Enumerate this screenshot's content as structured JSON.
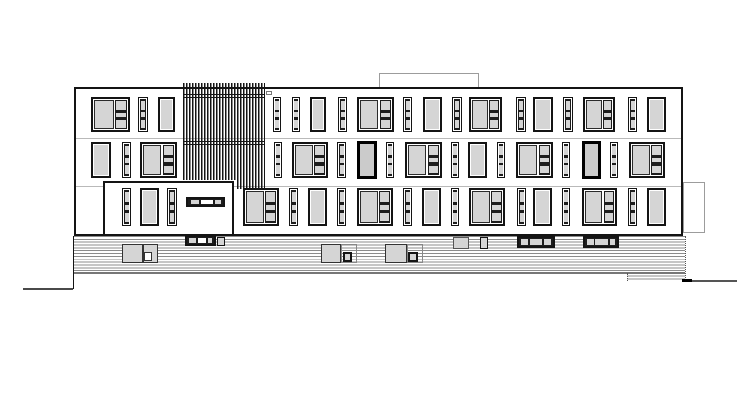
{
  "drawing": {
    "kind": "architectural-elevation",
    "canvas": {
      "width": 755,
      "height": 412,
      "background": "#ffffff"
    }
  },
  "colors": {
    "ink": "#141414",
    "pane": "#d5d5d5",
    "paneDark": "#cbcbcb",
    "innerDark": "#1d1d1d",
    "floorLine": "#b9b9b9",
    "stripe": "#8c8c8c",
    "lightLine": "#9c9c9c",
    "ground": "#4a4a4a",
    "white": "#ffffff"
  },
  "window_styles": {
    "plain": {
      "border": 2,
      "bg": "pane",
      "rim": 1
    },
    "thick": {
      "border": 3,
      "bg": "paneDark"
    },
    "narrow": {
      "border": 1.2,
      "inner_inset": 1,
      "inner": "innerDark",
      "panes": [
        [
          6,
          28
        ],
        [
          43,
          15
        ],
        [
          67,
          27
        ]
      ],
      "pane_l": 10,
      "pane_w": 80
    },
    "composite": {
      "border": 2,
      "left": [
        3,
        4,
        56,
        92
      ],
      "col": [
        63,
        2,
        34,
        96
      ],
      "panes": [
        [
          5,
          30
        ],
        [
          45,
          13
        ],
        [
          68,
          26
        ]
      ],
      "pane_l": 10,
      "pane_w": 80
    }
  },
  "elements_below": [
    {
      "type": "rect",
      "name": "roof-structure-outline",
      "x": 379,
      "y": 73,
      "w": 100,
      "h": 15,
      "bw": 1,
      "bc": "lightLine",
      "bg": "white"
    },
    {
      "type": "rect",
      "name": "side-annex-outline",
      "x": 683,
      "y": 182,
      "w": 22,
      "h": 51,
      "bw": 1,
      "bc": "lightLine",
      "bg": "white"
    },
    {
      "type": "rect",
      "name": "facade-outline",
      "x": 74,
      "y": 87,
      "w": 609,
      "h": 149,
      "bw": 2,
      "bc": "ink",
      "bg": "white"
    },
    {
      "type": "hline",
      "name": "floor-line-upper",
      "x": 76,
      "y": 138,
      "len": 605,
      "th": 1,
      "color": "floorLine"
    },
    {
      "type": "hline",
      "name": "floor-line-lower",
      "x": 76,
      "y": 186,
      "len": 605,
      "th": 1,
      "color": "floorLine"
    },
    {
      "type": "rect",
      "name": "ground-floor-volume",
      "x": 103,
      "y": 181,
      "w": 131,
      "h": 55,
      "bw": 2,
      "bc": "ink",
      "bg": "white"
    },
    {
      "type": "stripes",
      "name": "base-cladding",
      "x": 73,
      "y": 236,
      "w": 612,
      "h": 37,
      "period": 2.85,
      "lineW": 0.95,
      "color": "stripe"
    },
    {
      "type": "stripes",
      "name": "base-cladding-step",
      "x": 627,
      "y": 273,
      "w": 58,
      "h": 8,
      "period": 2.7,
      "lineW": 0.95,
      "color": "stripe"
    },
    {
      "type": "hline",
      "name": "base-bottom-line",
      "x": 73,
      "y": 272,
      "len": 612,
      "th": 1.5,
      "color": "#777777"
    },
    {
      "type": "vline",
      "name": "base-right-edge",
      "x": 684.5,
      "y": 236,
      "len": 44,
      "th": 1,
      "style": "dotted",
      "color": "#555555"
    },
    {
      "type": "vline",
      "name": "base-step-edge",
      "x": 627,
      "y": 273,
      "len": 8,
      "th": 1,
      "style": "dotted",
      "color": "#555555"
    },
    {
      "type": "vline",
      "name": "lower-left-wall",
      "x": 72.5,
      "y": 236,
      "len": 53,
      "th": 1.5,
      "color": "ink"
    },
    {
      "type": "hline",
      "name": "ground-line-left",
      "x": 23,
      "y": 287.5,
      "len": 50,
      "th": 2,
      "color": "ground"
    },
    {
      "type": "hline",
      "name": "ground-line-right",
      "x": 683,
      "y": 279.5,
      "len": 54,
      "th": 2,
      "color": "#555555"
    },
    {
      "type": "rect",
      "name": "ground-line-right-accent",
      "x": 682,
      "y": 278.5,
      "w": 10,
      "h": 3,
      "bw": 0,
      "bc": "ink",
      "bg": "#000000"
    },
    {
      "type": "rect",
      "name": "basement-window",
      "x": 122,
      "y": 244,
      "w": 21,
      "h": 19,
      "bw": 1,
      "bc": "#333333",
      "bg": "pane"
    },
    {
      "type": "rect",
      "name": "basement-window",
      "x": 143,
      "y": 244,
      "w": 15,
      "h": 19,
      "bw": 1,
      "bc": "#333333",
      "bg": "pane"
    },
    {
      "type": "rect",
      "name": "basement-window-inset",
      "x": 144,
      "y": 252,
      "w": 8,
      "h": 9,
      "bw": 1,
      "bc": "#333333",
      "bg": "white"
    },
    {
      "type": "rect",
      "name": "basement-window",
      "x": 321,
      "y": 244,
      "w": 20,
      "h": 19,
      "bw": 1,
      "bc": "#333333",
      "bg": "pane"
    },
    {
      "type": "rect",
      "name": "basement-window-frame",
      "x": 341,
      "y": 244,
      "w": 16,
      "h": 19,
      "bw": 1,
      "bc": "#888888",
      "bg": "none"
    },
    {
      "type": "rect",
      "name": "basement-window-inset",
      "x": 343,
      "y": 252,
      "w": 9,
      "h": 10,
      "bw": 2,
      "bc": "ink",
      "bg": "pane"
    },
    {
      "type": "rect",
      "name": "basement-window",
      "x": 385,
      "y": 244,
      "w": 22,
      "h": 19,
      "bw": 1,
      "bc": "#333333",
      "bg": "pane"
    },
    {
      "type": "rect",
      "name": "basement-window-frame",
      "x": 407,
      "y": 244,
      "w": 16,
      "h": 19,
      "bw": 1,
      "bc": "#888888",
      "bg": "none"
    },
    {
      "type": "rect",
      "name": "basement-window-inset",
      "x": 408,
      "y": 252,
      "w": 10,
      "h": 10,
      "bw": 2,
      "bc": "ink",
      "bg": "pane"
    },
    {
      "type": "rect",
      "name": "vent-window",
      "x": 453,
      "y": 237,
      "w": 16,
      "h": 12,
      "bw": 1,
      "bc": "#555555",
      "bg": "pane"
    },
    {
      "type": "rect",
      "name": "vent-window",
      "x": 480,
      "y": 237,
      "w": 8,
      "h": 12,
      "bw": 1,
      "bc": "ink",
      "bg": "pane"
    },
    {
      "type": "rect",
      "name": "base-ribbon-endcap",
      "x": 217,
      "y": 236.5,
      "w": 8,
      "h": 9,
      "bw": 1.5,
      "bc": "ink",
      "bg": "pane"
    }
  ],
  "strips": [
    {
      "name": "entrance-ribbon-window",
      "x": 186,
      "y": 197,
      "w": 39,
      "h": 10,
      "panes": [
        [
          8,
          24,
          "pane"
        ],
        [
          38,
          34,
          "white"
        ],
        [
          78,
          15,
          "pane"
        ]
      ]
    },
    {
      "name": "base-ribbon-window",
      "x": 185,
      "y": 235,
      "w": 31,
      "h": 11,
      "panes": [
        [
          8,
          26,
          "pane"
        ],
        [
          42,
          30,
          "white"
        ],
        [
          78,
          15,
          "pane"
        ]
      ]
    },
    {
      "name": "vent-strip",
      "x": 517,
      "y": 236,
      "w": 38,
      "h": 12,
      "panes": [
        [
          5,
          22,
          "pane"
        ],
        [
          32,
          36,
          "pane"
        ],
        [
          73,
          22,
          "pane"
        ]
      ]
    },
    {
      "name": "vent-strip",
      "x": 583,
      "y": 236,
      "w": 36,
      "h": 12,
      "panes": [
        [
          5,
          22,
          "pane"
        ],
        [
          32,
          40,
          "pane"
        ],
        [
          77,
          18,
          "pane"
        ]
      ]
    }
  ],
  "windows": [
    {
      "row": 1,
      "y": 97,
      "h": 35,
      "items": [
        [
          "composite",
          91,
          39
        ],
        [
          "narrow",
          138,
          10
        ],
        [
          "plain",
          158,
          17
        ],
        [
          "narrow",
          273,
          8
        ],
        [
          "narrow",
          292,
          8
        ],
        [
          "plain",
          310,
          16
        ],
        [
          "narrow",
          338,
          9
        ],
        [
          "composite",
          357,
          37
        ],
        [
          "narrow",
          403,
          9
        ],
        [
          "plain",
          423,
          19
        ],
        [
          "narrow",
          452,
          10
        ],
        [
          "composite",
          469,
          33
        ],
        [
          "narrow",
          516,
          10
        ],
        [
          "plain",
          533,
          20
        ],
        [
          "narrow",
          563,
          10
        ],
        [
          "composite",
          583,
          32
        ],
        [
          "narrow",
          628,
          9
        ],
        [
          "plain",
          647,
          19
        ]
      ]
    },
    {
      "row": 2,
      "y": 142,
      "h": 36,
      "items": [
        [
          "plain",
          91,
          20
        ],
        [
          "narrow",
          122,
          9
        ],
        [
          "composite",
          140,
          37
        ],
        [
          "narrow",
          274,
          8
        ],
        [
          "composite",
          292,
          36
        ],
        [
          "narrow",
          337,
          9
        ],
        [
          "thick",
          357,
          20
        ],
        [
          "narrow",
          386,
          8
        ],
        [
          "composite",
          405,
          37
        ],
        [
          "narrow",
          451,
          8
        ],
        [
          "plain",
          468,
          19
        ],
        [
          "narrow",
          497,
          8
        ],
        [
          "composite",
          516,
          37
        ],
        [
          "narrow",
          562,
          8
        ],
        [
          "thick",
          582,
          19
        ],
        [
          "narrow",
          610,
          8
        ],
        [
          "composite",
          629,
          36
        ]
      ]
    },
    {
      "row": 3,
      "y": 188,
      "h": 38,
      "items": [
        [
          "narrow",
          122,
          9
        ],
        [
          "plain",
          140,
          19
        ],
        [
          "narrow",
          167,
          10
        ],
        [
          "composite",
          243,
          36
        ],
        [
          "narrow",
          289,
          9
        ],
        [
          "plain",
          308,
          19
        ],
        [
          "narrow",
          337,
          9
        ],
        [
          "composite",
          357,
          36
        ],
        [
          "narrow",
          403,
          9
        ],
        [
          "plain",
          422,
          19
        ],
        [
          "narrow",
          451,
          8
        ],
        [
          "composite",
          469,
          36
        ],
        [
          "narrow",
          517,
          9
        ],
        [
          "plain",
          533,
          19
        ],
        [
          "narrow",
          562,
          8
        ],
        [
          "composite",
          582,
          35
        ],
        [
          "narrow",
          628,
          9
        ],
        [
          "plain",
          647,
          19
        ]
      ]
    }
  ],
  "louvers": {
    "x": 183,
    "y": 83,
    "w": 82,
    "h": 97,
    "slat": 1.7,
    "period": 3,
    "extension": {
      "x": 237,
      "y": 180,
      "w": 28,
      "h": 9
    },
    "cap": {
      "x": 265.5,
      "y": 90.5,
      "w": 6.5,
      "h": 4.5
    },
    "cross_lines": [
      94,
      96.5,
      141,
      143.5
    ]
  }
}
